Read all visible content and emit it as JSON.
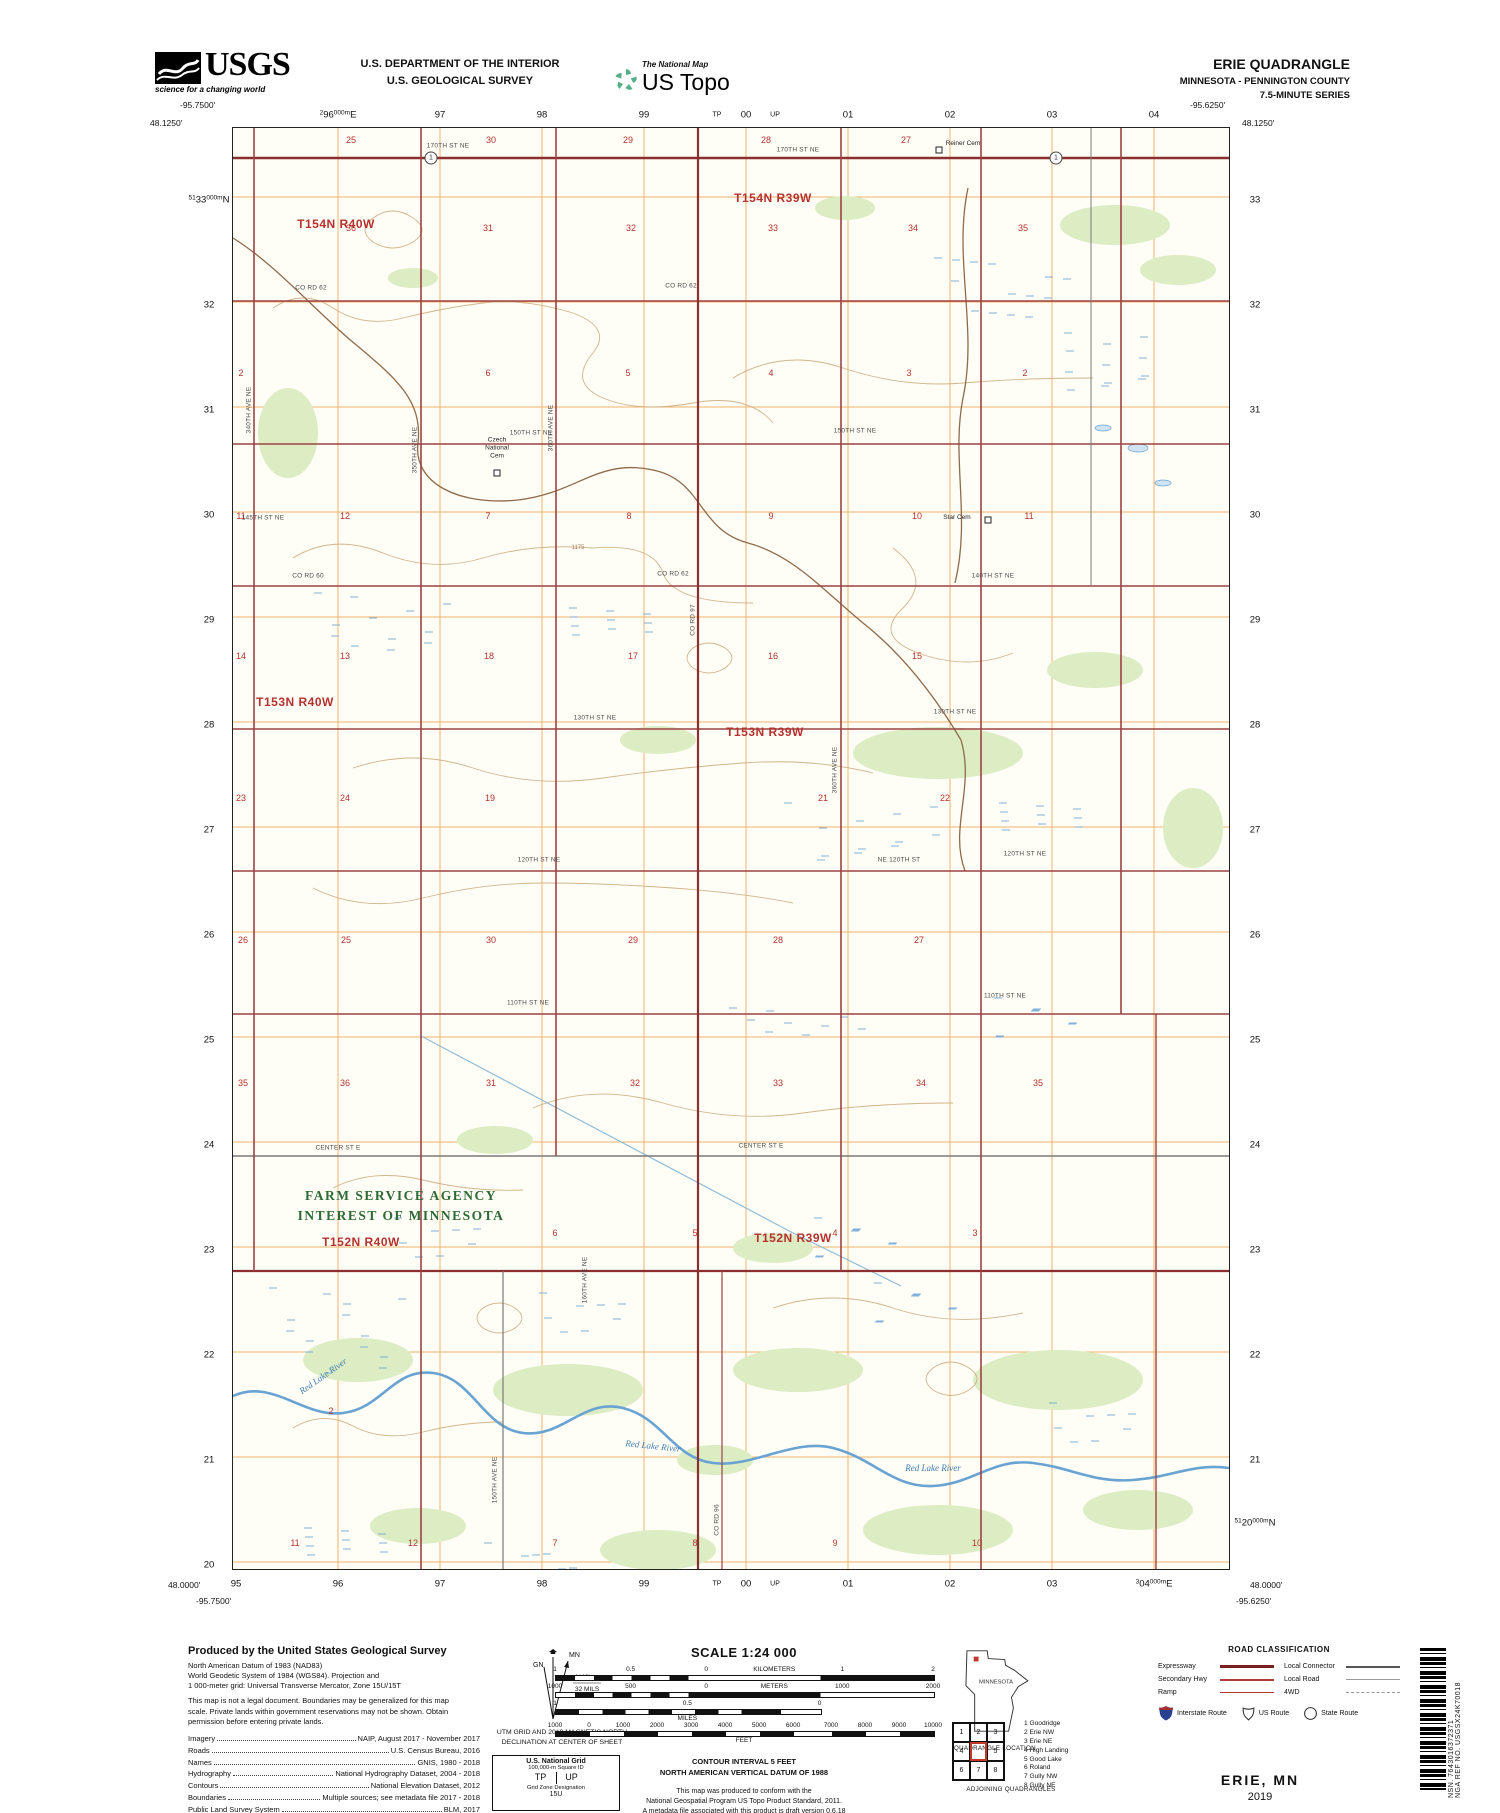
{
  "header": {
    "usgs_word": "USGS",
    "usgs_tagline": "science for a changing world",
    "dept_line1": "U.S. DEPARTMENT OF THE INTERIOR",
    "dept_line2": "U.S. GEOLOGICAL SURVEY",
    "ustopo_super": "The National Map",
    "ustopo_word": "US Topo",
    "quad_title": "ERIE QUADRANGLE",
    "quad_subtitle": "MINNESOTA - PENNINGTON COUNTY",
    "quad_series": "7.5-MINUTE SERIES"
  },
  "map": {
    "corners": {
      "tl_lon": "-95.7500'",
      "tl_lat": "48.1250'",
      "tr_lon": "-95.6250'",
      "tr_lat": "48.1250'",
      "bl_lat": "48.0000'",
      "bl_lon": "-95.7500'",
      "br_lat": "48.0000'",
      "br_lon": "-95.6250'"
    },
    "top_grid": [
      {
        "sm": "2",
        "lg": "96",
        "sm2": "000m",
        "lg2": "E",
        "x": 105
      },
      {
        "lg": "97",
        "x": 207
      },
      {
        "lg": "98",
        "x": 309
      },
      {
        "lg": "99",
        "x": 411
      },
      {
        "lg": "TP",
        "x": 484,
        "tiny": true
      },
      {
        "lg": "00",
        "x": 513
      },
      {
        "lg": "UP",
        "x": 542,
        "tiny": true
      },
      {
        "lg": "01",
        "x": 615
      },
      {
        "lg": "02",
        "x": 717
      },
      {
        "lg": "03",
        "x": 819
      },
      {
        "lg": "04",
        "x": 921
      }
    ],
    "bottom_grid": [
      {
        "lg": "95",
        "x": 3
      },
      {
        "lg": "96",
        "x": 105
      },
      {
        "lg": "97",
        "x": 207
      },
      {
        "lg": "98",
        "x": 309
      },
      {
        "lg": "99",
        "x": 411
      },
      {
        "lg": "TP",
        "x": 484,
        "tiny": true
      },
      {
        "lg": "00",
        "x": 513
      },
      {
        "lg": "UP",
        "x": 542,
        "tiny": true
      },
      {
        "lg": "01",
        "x": 615
      },
      {
        "lg": "02",
        "x": 717
      },
      {
        "lg": "03",
        "x": 819
      },
      {
        "sm": "3",
        "lg": "04",
        "sm2": "000m",
        "lg2": "E",
        "x": 921
      }
    ],
    "left_edge": [
      {
        "sm": "51",
        "lg": "33",
        "sm2": "000m",
        "lg2": "N",
        "y": 72
      },
      {
        "lg": "32",
        "y": 177
      },
      {
        "lg": "31",
        "y": 282
      },
      {
        "lg": "30",
        "y": 387
      },
      {
        "lg": "29",
        "y": 492
      },
      {
        "lg": "28",
        "y": 597
      },
      {
        "lg": "27",
        "y": 702
      },
      {
        "lg": "26",
        "y": 807
      },
      {
        "lg": "25",
        "y": 912
      },
      {
        "lg": "24",
        "y": 1017
      },
      {
        "lg": "23",
        "y": 1122
      },
      {
        "lg": "22",
        "y": 1227
      },
      {
        "lg": "21",
        "y": 1332
      },
      {
        "lg": "20",
        "y": 1437
      }
    ],
    "right_edge": [
      {
        "lg": "33",
        "y": 72
      },
      {
        "lg": "32",
        "y": 177
      },
      {
        "lg": "31",
        "y": 282
      },
      {
        "lg": "30",
        "y": 387
      },
      {
        "lg": "29",
        "y": 492
      },
      {
        "lg": "28",
        "y": 597
      },
      {
        "lg": "27",
        "y": 702
      },
      {
        "lg": "26",
        "y": 807
      },
      {
        "lg": "25",
        "y": 912
      },
      {
        "lg": "24",
        "y": 1017
      },
      {
        "lg": "23",
        "y": 1122
      },
      {
        "lg": "22",
        "y": 1227
      },
      {
        "lg": "21",
        "y": 1332
      },
      {
        "sm": "51",
        "lg": "20",
        "sm2": "000m",
        "lg2": "N",
        "y": 1395
      }
    ],
    "labels": [
      [
        "t",
        "T154N R40W",
        103,
        96
      ],
      [
        "t",
        "T154N R39W",
        540,
        70
      ],
      [
        "t",
        "T153N R40W",
        62,
        574
      ],
      [
        "t",
        "T153N R39W",
        532,
        604
      ],
      [
        "t",
        "T152N R40W",
        128,
        1114
      ],
      [
        "t",
        "T152N R39W",
        560,
        1110
      ],
      [
        "s",
        "25",
        118,
        12
      ],
      [
        "s",
        "30",
        258,
        12
      ],
      [
        "s",
        "29",
        395,
        12
      ],
      [
        "s",
        "28",
        533,
        12
      ],
      [
        "s",
        "27",
        673,
        12
      ],
      [
        "s",
        "36",
        118,
        100
      ],
      [
        "s",
        "31",
        255,
        100
      ],
      [
        "s",
        "32",
        398,
        100
      ],
      [
        "s",
        "33",
        540,
        100
      ],
      [
        "s",
        "34",
        680,
        100
      ],
      [
        "s",
        "35",
        790,
        100
      ],
      [
        "s",
        "2",
        8,
        245
      ],
      [
        "s",
        "6",
        255,
        245
      ],
      [
        "s",
        "5",
        395,
        245
      ],
      [
        "s",
        "4",
        538,
        245
      ],
      [
        "s",
        "3",
        676,
        245
      ],
      [
        "s",
        "2",
        792,
        245
      ],
      [
        "s",
        "11",
        8,
        388
      ],
      [
        "s",
        "12",
        112,
        388
      ],
      [
        "s",
        "7",
        255,
        388
      ],
      [
        "s",
        "8",
        396,
        388
      ],
      [
        "s",
        "9",
        538,
        388
      ],
      [
        "s",
        "10",
        684,
        388
      ],
      [
        "s",
        "11",
        796,
        388
      ],
      [
        "s",
        "14",
        8,
        528
      ],
      [
        "s",
        "13",
        112,
        528
      ],
      [
        "s",
        "18",
        256,
        528
      ],
      [
        "s",
        "17",
        400,
        528
      ],
      [
        "s",
        "16",
        540,
        528
      ],
      [
        "s",
        "15",
        684,
        528
      ],
      [
        "s",
        "23",
        8,
        670
      ],
      [
        "s",
        "24",
        112,
        670
      ],
      [
        "s",
        "19",
        257,
        670
      ],
      [
        "s",
        "21",
        590,
        670
      ],
      [
        "s",
        "22",
        712,
        670
      ],
      [
        "s",
        "26",
        10,
        812
      ],
      [
        "s",
        "25",
        113,
        812
      ],
      [
        "s",
        "30",
        258,
        812
      ],
      [
        "s",
        "29",
        400,
        812
      ],
      [
        "s",
        "28",
        545,
        812
      ],
      [
        "s",
        "27",
        686,
        812
      ],
      [
        "s",
        "35",
        10,
        955
      ],
      [
        "s",
        "36",
        112,
        955
      ],
      [
        "s",
        "31",
        258,
        955
      ],
      [
        "s",
        "32",
        402,
        955
      ],
      [
        "s",
        "33",
        545,
        955
      ],
      [
        "s",
        "34",
        688,
        955
      ],
      [
        "s",
        "35",
        805,
        955
      ],
      [
        "s",
        "6",
        322,
        1105
      ],
      [
        "s",
        "5",
        462,
        1105
      ],
      [
        "s",
        "4",
        602,
        1105
      ],
      [
        "s",
        "3",
        742,
        1105
      ],
      [
        "s",
        "2",
        98,
        1283
      ],
      [
        "s",
        "11",
        62,
        1415
      ],
      [
        "s",
        "12",
        180,
        1415
      ],
      [
        "s",
        "7",
        322,
        1415
      ],
      [
        "s",
        "8",
        462,
        1415
      ],
      [
        "s",
        "9",
        602,
        1415
      ],
      [
        "s",
        "10",
        744,
        1415
      ],
      [
        "r",
        "170TH ST NE",
        215,
        18
      ],
      [
        "r",
        "170TH ST NE",
        565,
        22
      ],
      [
        "r",
        "CO RD 62",
        78,
        160
      ],
      [
        "r",
        "CO RD 62",
        448,
        158
      ],
      [
        "r",
        "150TH ST NE",
        298,
        305
      ],
      [
        "r",
        "150TH ST NE",
        622,
        303
      ],
      [
        "r",
        "145TH ST NE",
        30,
        390
      ],
      [
        "r",
        "CO RD 60",
        75,
        448
      ],
      [
        "r",
        "CO RD 62",
        440,
        446
      ],
      [
        "r",
        "140TH ST NE",
        760,
        448
      ],
      [
        "r",
        "130TH ST NE",
        362,
        590
      ],
      [
        "r",
        "130TH ST NE",
        722,
        584
      ],
      [
        "r",
        "120TH ST NE",
        306,
        732
      ],
      [
        "r",
        "NE 120TH ST",
        666,
        732
      ],
      [
        "r",
        "120TH ST NE",
        792,
        726
      ],
      [
        "r",
        "110TH ST NE",
        295,
        875
      ],
      [
        "r",
        "110TH ST NE",
        772,
        868
      ],
      [
        "r",
        "CENTER ST E",
        105,
        1020
      ],
      [
        "r",
        "CENTER ST E",
        528,
        1018
      ],
      [
        "rv",
        "340TH AVE NE",
        16,
        282
      ],
      [
        "rv",
        "350TH AVE NE",
        182,
        322
      ],
      [
        "rv",
        "360TH AVE NE",
        318,
        300
      ],
      [
        "rv",
        "CO RD 97",
        460,
        492
      ],
      [
        "rv",
        "360TH AVE NE",
        602,
        642
      ],
      [
        "rv",
        "160TH AVE NE",
        352,
        1152
      ],
      [
        "rv",
        "150TH AVE NE",
        262,
        1352
      ],
      [
        "rv",
        "CO RD 96",
        484,
        1392
      ],
      [
        "p",
        "Czech\nNational\nCem",
        264,
        320
      ],
      [
        "p",
        "Star Cem",
        724,
        390
      ],
      [
        "p",
        "Reiner Cem",
        730,
        16
      ],
      [
        "w",
        "Red Lake River",
        90,
        1248,
        -35
      ],
      [
        "w",
        "Red Lake River",
        420,
        1318,
        6
      ],
      [
        "w",
        "Red Lake River",
        700,
        1340,
        0
      ],
      [
        "g",
        "FARM SERVICE AGENCY\nINTEREST OF MINNESOTA",
        168,
        1078
      ],
      [
        "e",
        "1175",
        345,
        420
      ]
    ],
    "cemetery_squares": [
      [
        264,
        345
      ],
      [
        755,
        392
      ],
      [
        706,
        22
      ]
    ],
    "route_markers": [
      {
        "n": "1",
        "x": 198,
        "y": 30
      },
      {
        "n": "1",
        "x": 823,
        "y": 30
      }
    ]
  },
  "collar": {
    "produced_by": {
      "title": "Produced by the United States Geological Survey",
      "datum_lines": [
        "North American Datum of 1983 (NAD83)",
        "World Geodetic System of 1984 (WGS84). Projection and",
        "1 000-meter grid: Universal Transverse Mercator, Zone 15U/15T"
      ],
      "disclaimer": "This map is not a legal document. Boundaries may be generalized for this map scale. Private lands within government reservations may not be shown. Obtain permission before entering private lands.",
      "sources": [
        [
          "Imagery",
          "NAIP, August 2017 - November 2017"
        ],
        [
          "Roads",
          "U.S. Census Bureau, 2016"
        ],
        [
          "Names",
          "GNIS, 1980 - 2018"
        ],
        [
          "Hydrography",
          "National Hydrography Dataset, 2004 - 2018"
        ],
        [
          "Contours",
          "National Elevation Dataset, 2012"
        ],
        [
          "Boundaries",
          "Multiple sources; see metadata file 2017 - 2018"
        ],
        [
          "Public Land Survey System",
          "BLM, 2017"
        ],
        [
          "Wetlands",
          "FWS National Wetlands Inventory 1982 - 1983"
        ]
      ]
    },
    "declination": {
      "mn": "MN",
      "gn": "GN",
      "value": "1°48'",
      "mils": "32 MILS",
      "caption_line1": "UTM GRID AND 2019 MAGNETIC NORTH",
      "caption_line2": "DECLINATION AT CENTER OF SHEET"
    },
    "usng": {
      "title": "U.S. National Grid",
      "square_id_label": "100,000-m Square ID",
      "ids": [
        "TP",
        "UP"
      ],
      "zone_label": "Grid Zone Designation",
      "zone": "15U"
    },
    "scale": {
      "title": "SCALE 1:24 000",
      "km_ticks": [
        [
          "1",
          0
        ],
        [
          "0.5",
          20
        ],
        [
          "0",
          40
        ],
        [
          "KILOMETERS",
          58
        ],
        [
          "1",
          76
        ],
        [
          "2",
          100
        ]
      ],
      "m_ticks": [
        [
          "1000",
          0
        ],
        [
          "500",
          20
        ],
        [
          "0",
          40
        ],
        [
          "METERS",
          58
        ],
        [
          "1000",
          76
        ],
        [
          "2000",
          100
        ]
      ],
      "mi_ticks": [
        [
          "1",
          0
        ],
        [
          "0.5",
          35
        ],
        [
          "0",
          70
        ]
      ],
      "mi_label": "MILES",
      "ft_ticks": [
        [
          "1000",
          0
        ],
        [
          "0",
          9
        ],
        [
          "1000",
          18
        ],
        [
          "2000",
          27
        ],
        [
          "3000",
          36
        ],
        [
          "4000",
          45
        ],
        [
          "5000",
          54
        ],
        [
          "6000",
          63
        ],
        [
          "7000",
          73
        ],
        [
          "8000",
          82
        ],
        [
          "9000",
          91
        ],
        [
          "10000",
          100
        ]
      ],
      "ft_label": "FEET",
      "contour_line1": "CONTOUR INTERVAL 5 FEET",
      "contour_line2": "NORTH AMERICAN VERTICAL DATUM OF 1988",
      "conform_lines": [
        "This map was produced to conform with the",
        "National Geospatial Program US Topo Product Standard, 2011.",
        "A metadata file associated with this product is draft version 0.6.18"
      ]
    },
    "location": {
      "state": "MINNESOTA",
      "caption": "QUADRANGLE LOCATION"
    },
    "adjoining": {
      "caption": "ADJOINING QUADRANGLES",
      "cells": [
        "1",
        "2",
        "3",
        "4",
        "",
        "5",
        "6",
        "7",
        "8"
      ],
      "names": [
        "1 Goodridge",
        "2 Erie NW",
        "3 Erie NE",
        "4 High Landing",
        "5 Good Lake",
        "6 Roland",
        "7 Gully NW",
        "8 Gully NE"
      ]
    },
    "road_class": {
      "title": "ROAD CLASSIFICATION",
      "left_rows": [
        [
          "Expressway",
          "expressway"
        ],
        [
          "Secondary Hwy",
          "secondary"
        ],
        [
          "Ramp",
          "ramp"
        ]
      ],
      "right_rows": [
        [
          "Local Connector",
          "connector"
        ],
        [
          "Local Road",
          "local"
        ],
        [
          "4WD",
          "fourwd"
        ]
      ],
      "shield_interstate": "Interstate Route",
      "shield_us": "US Route",
      "shield_state": "State Route"
    },
    "footer": {
      "map_name": "ERIE, MN",
      "year": "2019"
    },
    "sidebar": {
      "nsn": "NSN. 7643016372371",
      "nga": "NGA REF NO. USGSX24K70018"
    }
  }
}
